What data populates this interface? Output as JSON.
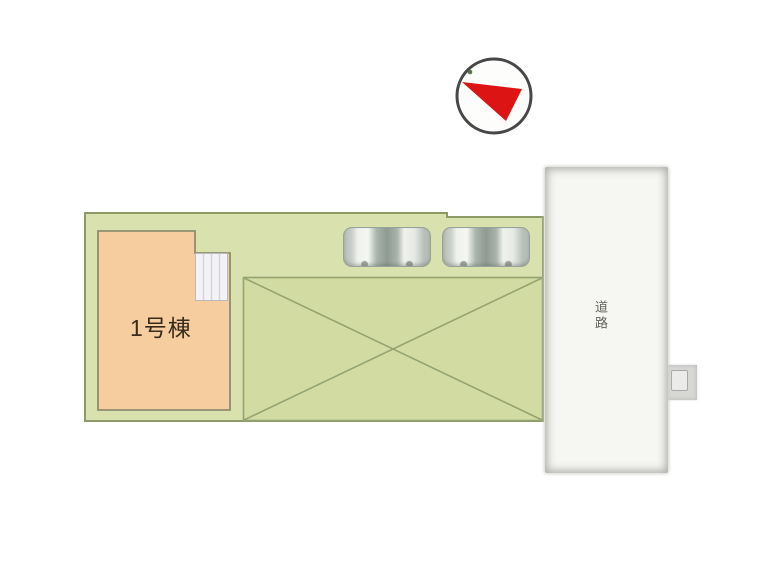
{
  "plan": {
    "building": {
      "label": "1号棟",
      "fill": "#f5cd9f",
      "stroke": "#8e8e71"
    },
    "road": {
      "label": "道路",
      "fill": "#f6f6f3"
    },
    "plot": {
      "fill": "#d9e1ae",
      "stroke": "#8d9a66"
    },
    "courtyard": {
      "fill": "#d2dca2",
      "stroke": "#94a371"
    },
    "porch": {
      "fill": "#f3f3f6",
      "stroke": "#b9b9bf"
    },
    "compass": {
      "icon": "compass-north-arrow",
      "needle_color": "#dd1414",
      "ring_color": "#474747",
      "dot_color": "#57724c"
    },
    "cars": {
      "count": 2,
      "icon": "car-top-view"
    }
  }
}
